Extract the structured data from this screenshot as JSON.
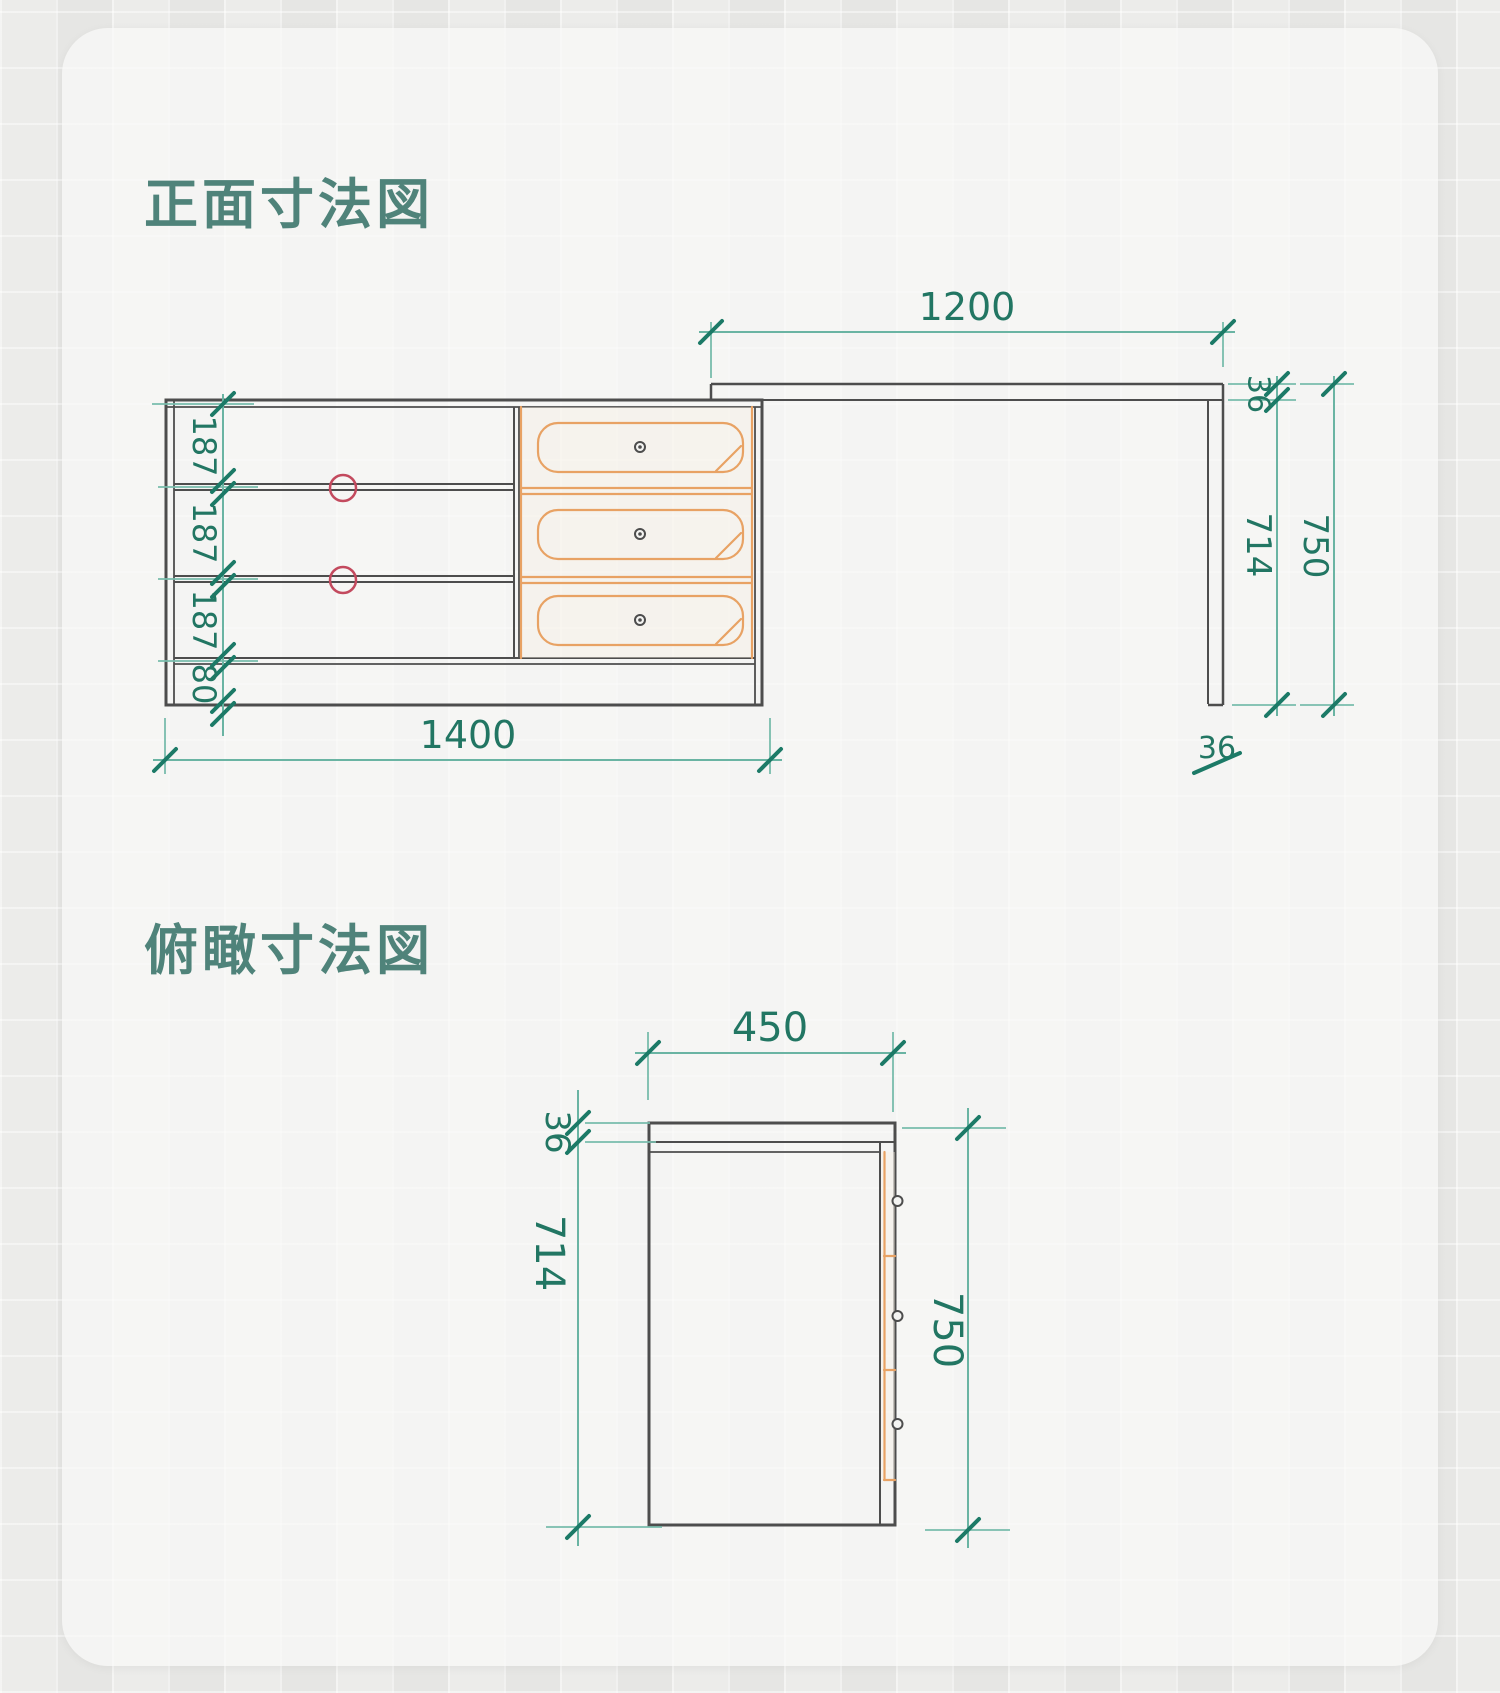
{
  "front_view": {
    "title": "正面寸法図",
    "dimensions": {
      "desk_width": "1200",
      "cabinet_width": "1400",
      "shelf_heights": [
        "187",
        "187",
        "187"
      ],
      "base_height": "80",
      "desktop_thickness": "36",
      "leg_height": "714",
      "total_height": "750",
      "leg_thickness": "36"
    }
  },
  "top_view": {
    "title": "俯瞰寸法図",
    "dimensions": {
      "depth": "450",
      "desktop_thickness": "36",
      "cabinet_height": "714",
      "total_height": "750"
    }
  },
  "colors": {
    "title_green": "#4f837a",
    "dimension_text_teal": "#227663",
    "dimension_line_teal": "#6ab4a3",
    "tick_teal": "#1c7a67",
    "cabinet_gray": "#4d4d4d",
    "drawer_orange": "#e8a264",
    "marker_red": "#c34a5e",
    "panel_background": "#f7f7f5",
    "page_background": "#e9e9e7"
  }
}
